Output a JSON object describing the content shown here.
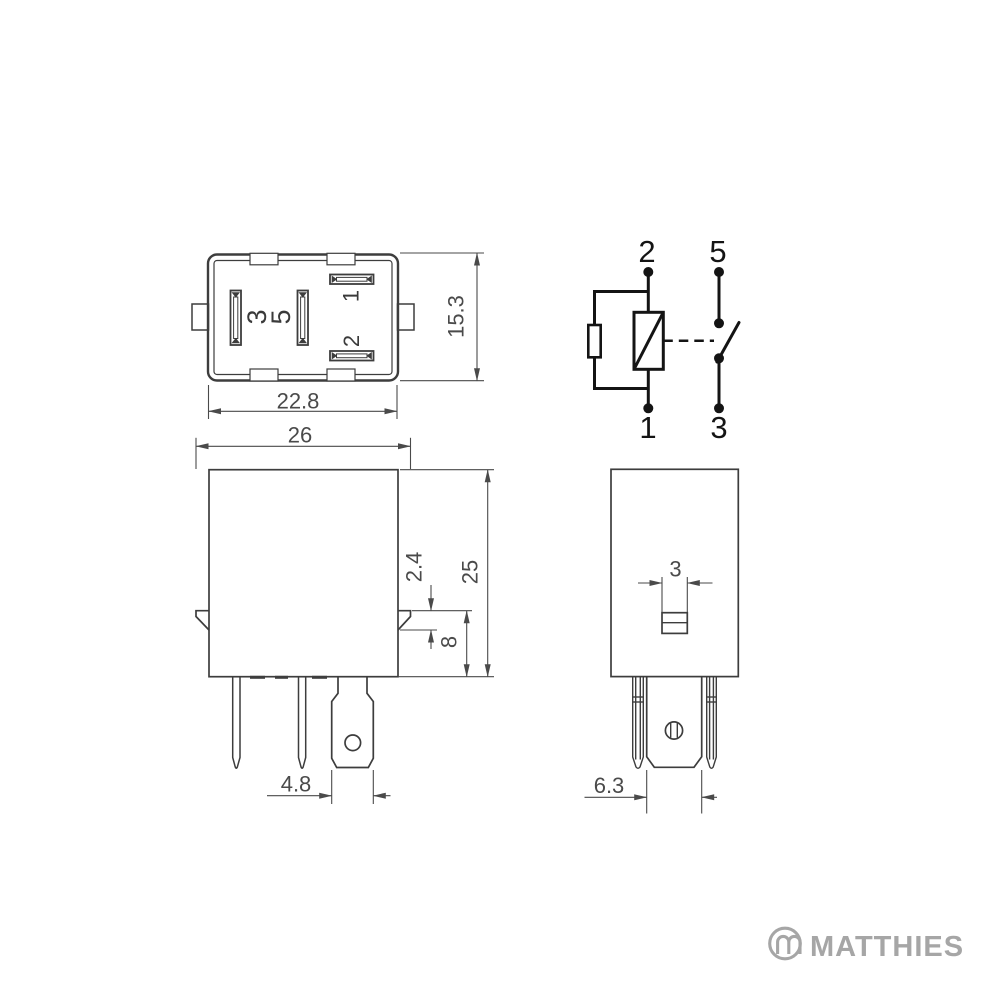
{
  "views": {
    "bottom_view": {
      "pin_labels": {
        "pin3": "3",
        "pin5": "5",
        "pin1": "1",
        "pin2": "2"
      },
      "dim_width": "22.8",
      "dim_height": "15.3"
    },
    "front_view": {
      "dim_width": "26",
      "dim_height": "25",
      "dim_flange_step": "2.4",
      "dim_flange_to_base": "8",
      "dim_blade_width": "4.8"
    },
    "side_view": {
      "dim_tab_width": "3",
      "dim_blade_width": "6.3"
    },
    "schematic": {
      "terminal_coil_top": "2",
      "terminal_coil_bottom": "1",
      "terminal_switch_top": "5",
      "terminal_switch_bottom": "3"
    }
  },
  "branding": {
    "logo_text": "MATTHIES",
    "logo_color": "#a6a6a6"
  },
  "colors": {
    "line": "#3d3d3d",
    "dim": "#4a4a4a",
    "schematic": "#141414",
    "background": "#ffffff"
  }
}
